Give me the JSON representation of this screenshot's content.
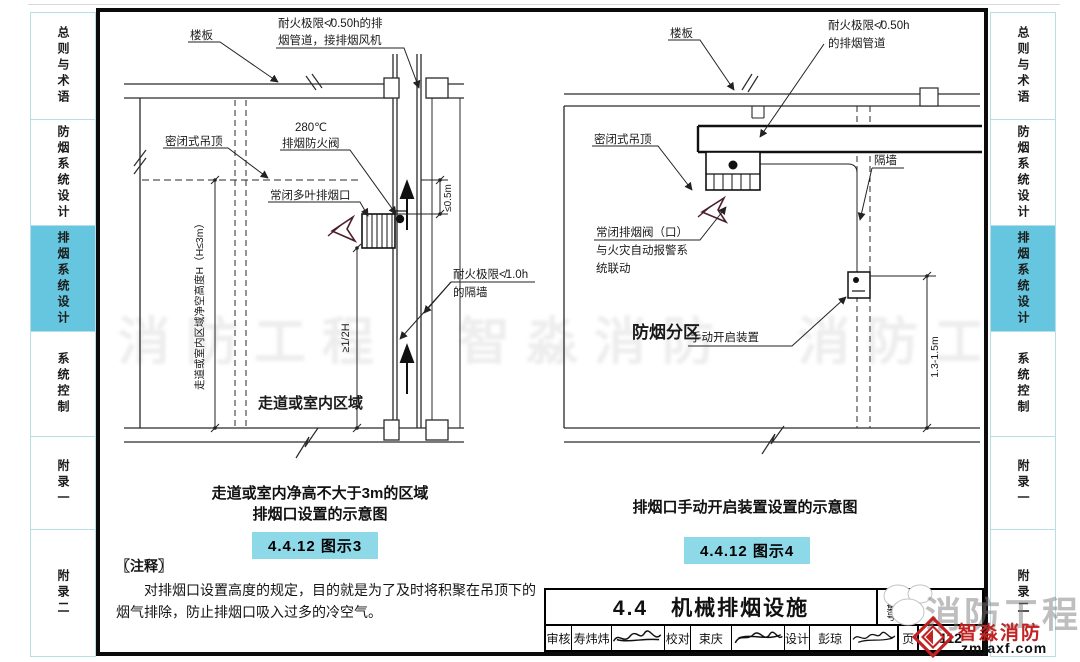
{
  "sidebar": {
    "tabs": [
      "总则与术语",
      "防烟系统设计",
      "排烟系统设计",
      "系统控制",
      "附录一",
      "附录二"
    ],
    "active_tab": "排烟系统设计"
  },
  "left": {
    "slab": "楼板",
    "duct1": "耐火极限≮0.50h的排",
    "duct2": "烟管道，接排烟风机",
    "ceiling": "密闭式吊顶",
    "temp": "280℃",
    "damper": "排烟防火阀",
    "vent": "常闭多叶排烟口",
    "wall1": "耐火极限≮1.0h",
    "wall2": "的隔墙",
    "area": "走道或室内区域",
    "dimH": "走道或室内区域净空高度H（H≤3m）",
    "dimHalf": "≥1/2H",
    "dimTop": "≤0.5m",
    "cap1": "走道或室内净高不大于3m的区域",
    "cap2": "排烟口设置的示意图",
    "badge": "4.4.12 图示3"
  },
  "right": {
    "slab": "楼板",
    "duct1": "耐火极限≮0.50h",
    "duct2": "的排烟管道",
    "ceiling": "密闭式吊顶",
    "valve1": "常闭排烟阀（口）",
    "valve2": "与火灾自动报警系",
    "valve3": "统联动",
    "zone": "防烟分区",
    "manual": "手动开启装置",
    "wall": "隔墙",
    "dim": "1.3-1.5m",
    "cap": "排烟口手动开启装置设置的示意图",
    "badge": "4.4.12 图示4"
  },
  "notes": {
    "header": "〖注释〗",
    "body": "对排烟口设置高度的规定，目的就是为了及时将积聚在吊顶下的烟气排除，防止排烟口吸入过多的冷空气。"
  },
  "titleblock": {
    "title": "4.4　机械排烟设施",
    "atlas_label": "图集号",
    "page_label": "页",
    "page": "112",
    "r_label": "审核",
    "r_name": "寿炜炜",
    "c_label": "校对",
    "c_name": "束庆",
    "d_label": "设计",
    "d_name": "彭琼"
  },
  "watermark": {
    "band": "消防工程　智淼消防　消防工程　智淼消防",
    "big": "消防工程",
    "brand": "智淼消防",
    "site": "zmjaxf.com"
  },
  "colors": {
    "accent": "#66c6df",
    "badge": "#8ed9e8",
    "brand_red": "#c32222"
  }
}
